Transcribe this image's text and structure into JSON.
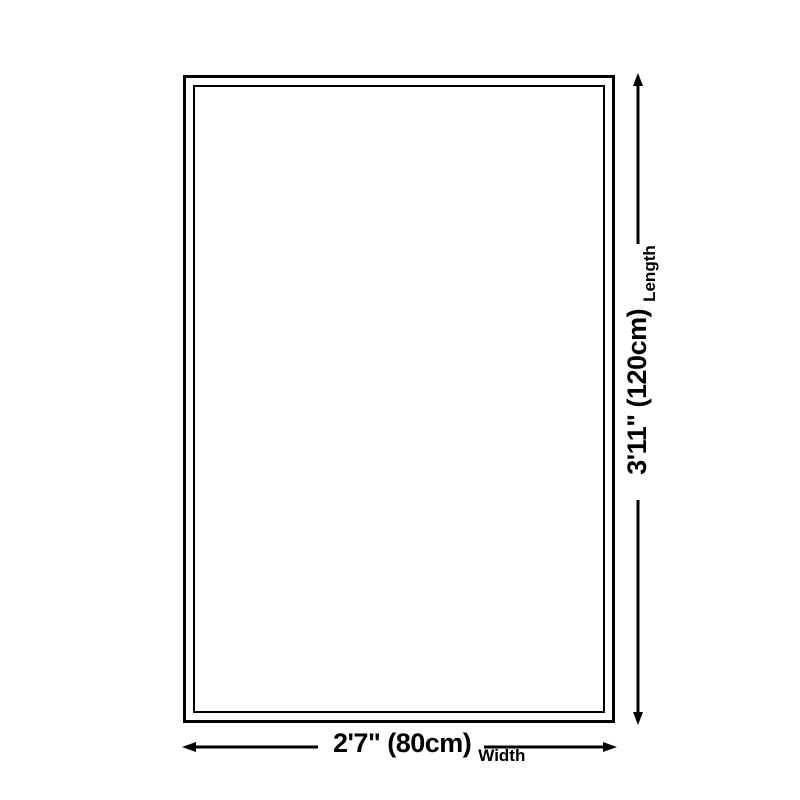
{
  "diagram": {
    "background_color": "#ffffff",
    "line_color": "#000000",
    "length_dimension": {
      "value": "3'11\" (120cm)",
      "label": "Length"
    },
    "width_dimension": {
      "value": "2'7\" (80cm)",
      "label": "Width"
    }
  }
}
